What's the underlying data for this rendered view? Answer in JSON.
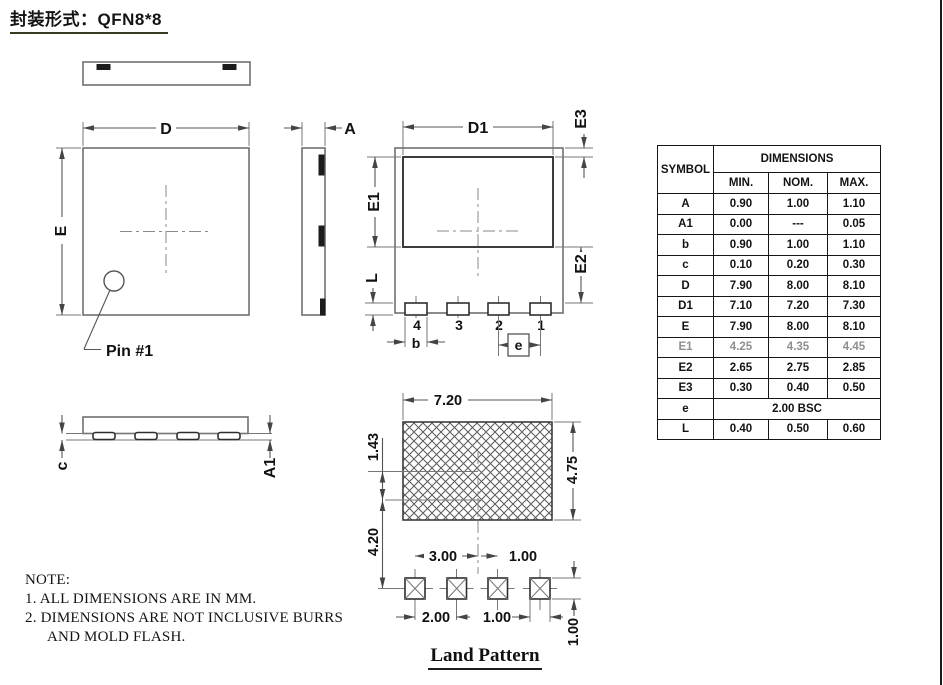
{
  "page": {
    "title": "封装形式：QFN8*8",
    "background": "#ffffff"
  },
  "colors": {
    "line": "#6f6f6f",
    "dim_line": "#555555",
    "text": "#111111",
    "table_border": "#161616",
    "muted_row_text": "#8f8f8f"
  },
  "views": {
    "top_view": {
      "dim_width": "D",
      "dim_height": "E",
      "pin1_label": "Pin #1"
    },
    "side_view": {
      "dim_thickness": "A"
    },
    "bottom_view": {
      "dim_pad_width": "D1",
      "dim_pad_height": "E1",
      "dim_edge_gap": "E2",
      "dim_top_gap": "E3",
      "dim_lead_length": "L",
      "dim_lead_width": "b",
      "dim_pitch": "e",
      "pin_numbers": [
        "4",
        "3",
        "2",
        "1"
      ]
    },
    "profile_view": {
      "dim_lead_thickness": "c",
      "dim_standoff": "A1"
    }
  },
  "land_pattern": {
    "title": "Land Pattern",
    "pad_area_width": "7.20",
    "pad_area_height": "4.75",
    "center_offset": "1.43",
    "row_offset": "4.20",
    "pitch_to_center": "3.00",
    "pitch_from_center": "1.00",
    "pad_pitch": "2.00",
    "pad_width": "1.00",
    "pad_height": "1.00"
  },
  "notes": {
    "heading": "NOTE:",
    "line1": "1. ALL DIMENSIONS ARE IN MM.",
    "line2": "2. DIMENSIONS ARE NOT INCLUSIVE BURRS",
    "line3": "AND MOLD FLASH."
  },
  "table": {
    "symbol_header": "SYMBOL",
    "dimensions_header": "DIMENSIONS",
    "col_headers": [
      "MIN.",
      "NOM.",
      "MAX."
    ],
    "rows": [
      {
        "sym": "A",
        "min": "0.90",
        "nom": "1.00",
        "max": "1.10"
      },
      {
        "sym": "A1",
        "min": "0.00",
        "nom": "---",
        "max": "0.05"
      },
      {
        "sym": "b",
        "min": "0.90",
        "nom": "1.00",
        "max": "1.10"
      },
      {
        "sym": "c",
        "min": "0.10",
        "nom": "0.20",
        "max": "0.30"
      },
      {
        "sym": "D",
        "min": "7.90",
        "nom": "8.00",
        "max": "8.10"
      },
      {
        "sym": "D1",
        "min": "7.10",
        "nom": "7.20",
        "max": "7.30"
      },
      {
        "sym": "E",
        "min": "7.90",
        "nom": "8.00",
        "max": "8.10"
      },
      {
        "sym": "E1",
        "min": "4.25",
        "nom": "4.35",
        "max": "4.45"
      },
      {
        "sym": "E2",
        "min": "2.65",
        "nom": "2.75",
        "max": "2.85"
      },
      {
        "sym": "E3",
        "min": "0.30",
        "nom": "0.40",
        "max": "0.50"
      },
      {
        "sym": "e",
        "bsc": "2.00 BSC"
      },
      {
        "sym": "L",
        "min": "0.40",
        "nom": "0.50",
        "max": "0.60"
      }
    ]
  }
}
